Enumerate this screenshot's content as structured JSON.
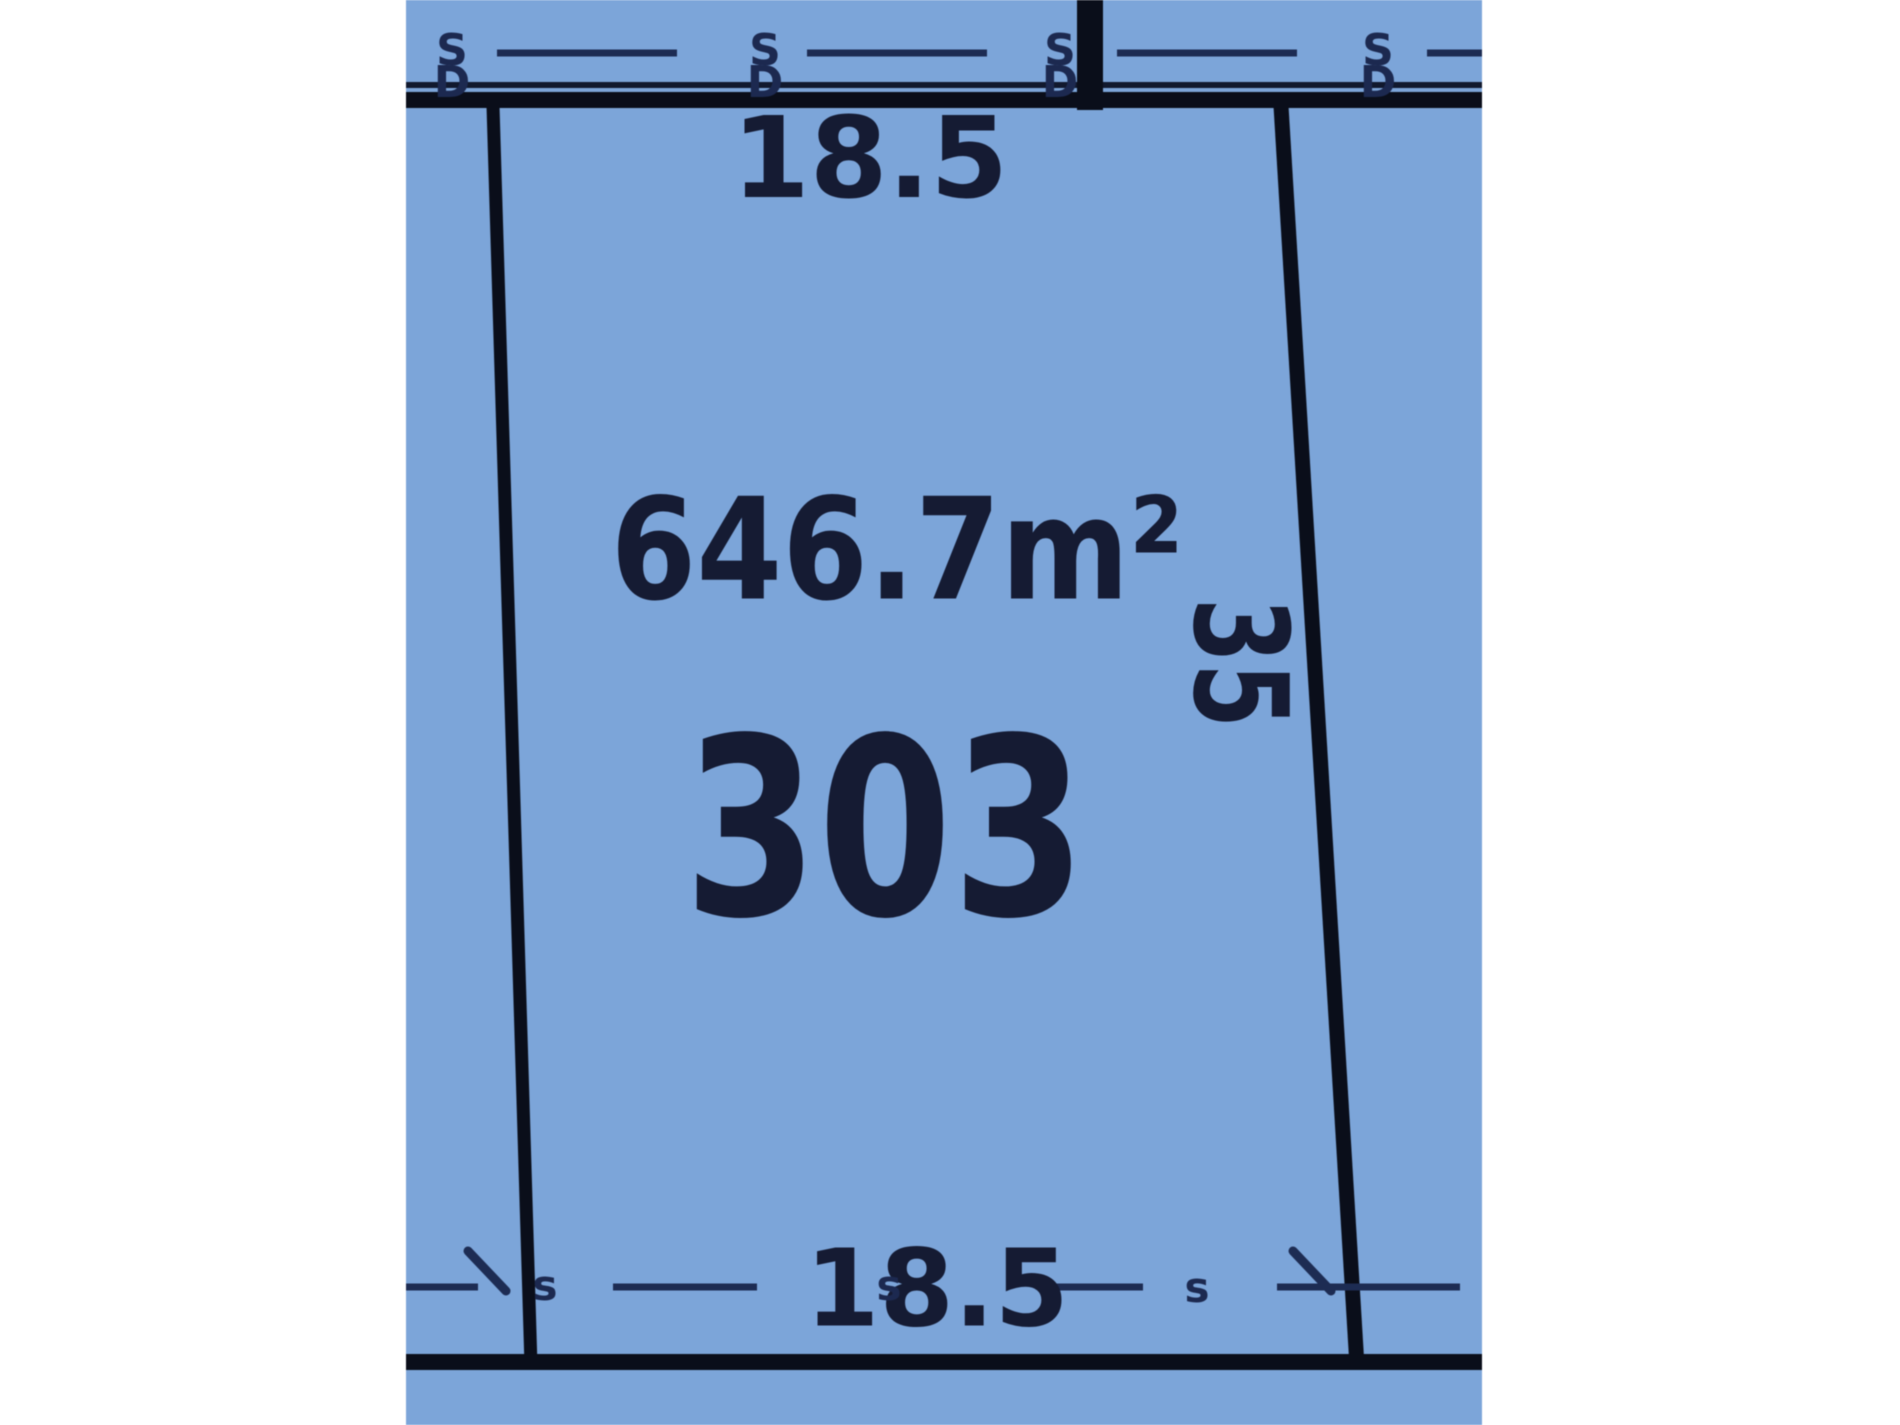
{
  "lot": {
    "number": "303",
    "area": "646.7m²",
    "frontage_top": "18.5",
    "frontage_bottom": "18.5",
    "depth_right": "35"
  },
  "boundary_markers": [
    {
      "top": "S",
      "bottom": "D"
    },
    {
      "top": "S",
      "bottom": "D"
    },
    {
      "top": "S",
      "bottom": "D"
    },
    {
      "top": "S",
      "bottom": "D"
    }
  ],
  "easement_marks": [
    "s",
    "s",
    "s"
  ],
  "colors": {
    "parcel_fill": "#7ca5d9",
    "boundary_line": "#0a0e1a",
    "thin_line": "#11192e",
    "dash_line": "#1d2c53",
    "text": "#151b33",
    "marker_text": "#1c2950",
    "background": "#ffffff"
  }
}
